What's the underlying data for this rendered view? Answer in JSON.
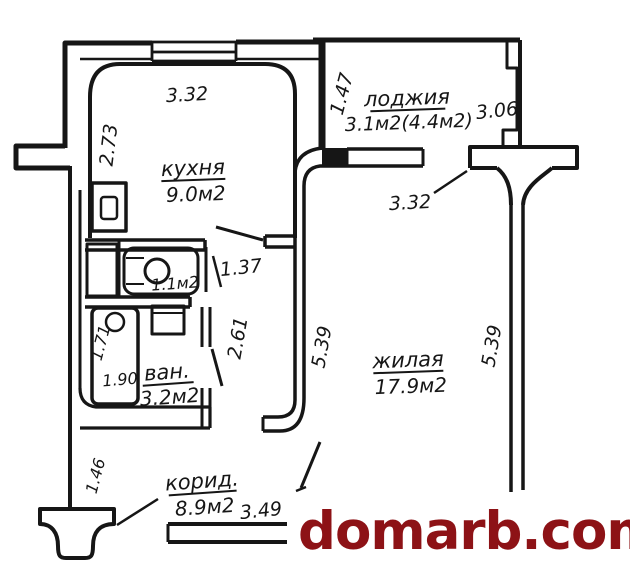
{
  "floorplan": {
    "watermark": "domarb.com",
    "colors": {
      "line": "#161616",
      "watermark": "#8d1216",
      "background": "#ffffff"
    },
    "rooms": {
      "kitchen": {
        "name": "кухня",
        "area": "9.0м2"
      },
      "loggia": {
        "name": "лоджия",
        "area": "3.1м2(4.4м2)"
      },
      "living": {
        "name": "жилая",
        "area": "17.9м2"
      },
      "bathroom": {
        "name": "ван.",
        "area": "3.2м2"
      },
      "toilet": {
        "area": "1.1м2"
      },
      "corridor": {
        "name": "корид.",
        "area": "8.9м2"
      }
    },
    "dims": {
      "kitchen_top": "3.32",
      "kitchen_left": "2.73",
      "loggia_left": "1.47",
      "loggia_right": "3.06",
      "living_top": "3.32",
      "living_left": "5.39",
      "living_right": "5.39",
      "toilet_door": "1.37",
      "hall_height": "2.61",
      "bath_left": "1.71",
      "bath_width": "1.90",
      "corridor_left": "1.46",
      "corridor_width": "3.49"
    }
  }
}
